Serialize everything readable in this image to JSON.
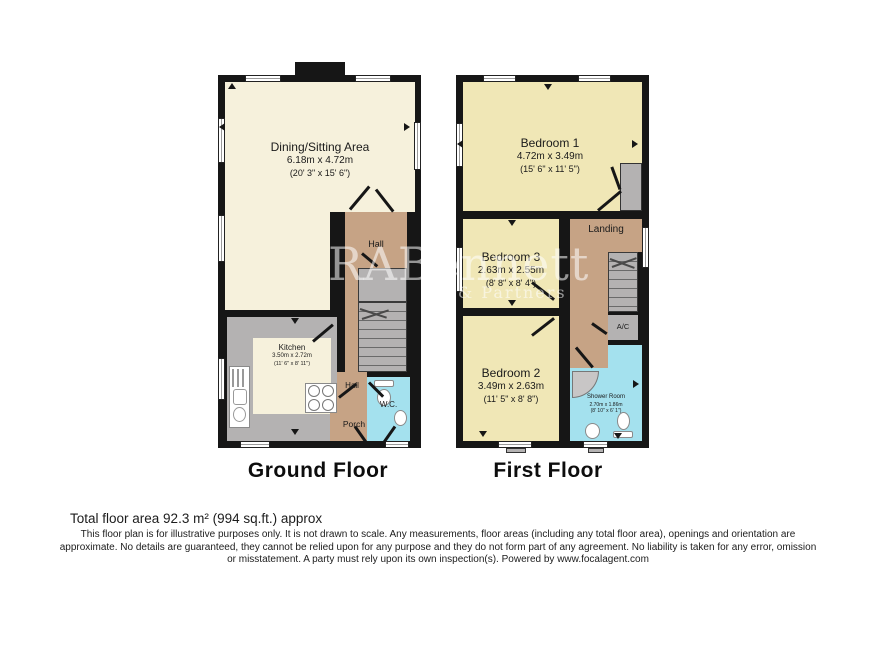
{
  "watermark": {
    "line1": "RABennett",
    "line2": "& Partners"
  },
  "ground_floor": {
    "label": "Ground Floor",
    "dining": {
      "name": "Dining/Sitting Area",
      "metric": "6.18m x 4.72m",
      "imperial": "(20' 3\" x 15' 6\")"
    },
    "kitchen": {
      "name": "Kitchen",
      "metric": "3.50m x 2.72m",
      "imperial": "(11' 6\" x 8' 11\")"
    },
    "hall_upper": "Hall",
    "hall_lower": "Hall",
    "porch": "Porch",
    "wc": "W.C."
  },
  "first_floor": {
    "label": "First Floor",
    "bedroom1": {
      "name": "Bedroom 1",
      "metric": "4.72m x 3.49m",
      "imperial": "(15' 6\" x 11' 5\")"
    },
    "bedroom3": {
      "name": "Bedroom 3",
      "metric": "2.63m x 2.55m",
      "imperial": "(8' 8\" x 8' 4\")"
    },
    "bedroom2": {
      "name": "Bedroom 2",
      "metric": "3.49m x 2.63m",
      "imperial": "(11' 5\" x 8' 8\")"
    },
    "landing": "Landing",
    "ac": "A/C",
    "shower": {
      "name": "Shower Room",
      "metric": "2.70m x 1.86m",
      "imperial": "(8' 10\" x 6' 1\")"
    }
  },
  "footer": {
    "total_area": "Total floor area 92.3 m² (994 sq.ft.) approx",
    "disclaimer": "This floor plan is for illustrative purposes only. It is not drawn to scale. Any measurements, floor areas (including any total floor area), openings and orientation are approximate. No details are guaranteed, they cannot be relied upon for any purpose and they do not form part of any agreement. No liability is taken for any error, omission or misstatement. A party must rely upon its own inspection(s). Powered by www.focalagent.com"
  },
  "colors": {
    "wall": "#161616",
    "room_cream": "#f6f1dc",
    "room_yellow": "#f0e7b6",
    "hall_tan": "#c6a385",
    "wet_blue": "#a4e1ee",
    "unit_gray": "#b4b2b2"
  }
}
